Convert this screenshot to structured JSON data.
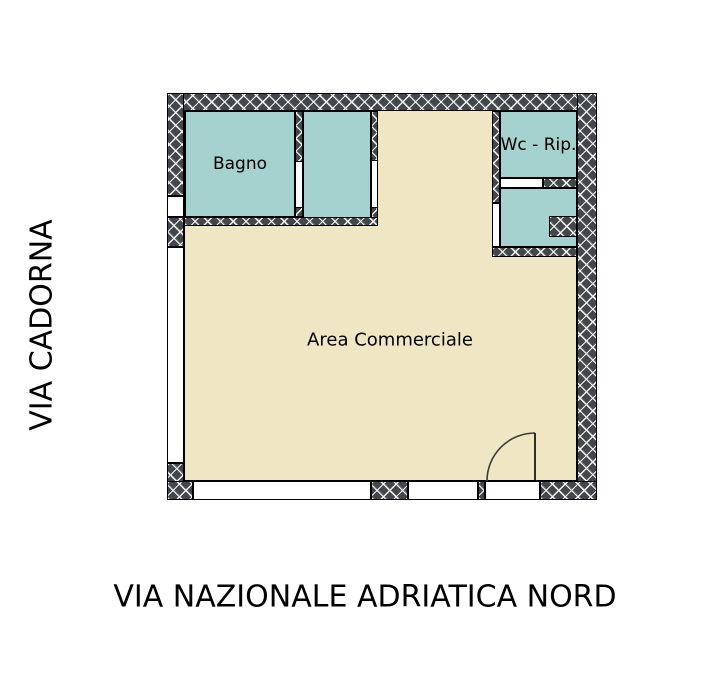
{
  "streets": {
    "left": "VIA CADORNA",
    "bottom": "VIA NAZIONALE ADRIATICA NORD"
  },
  "rooms": {
    "bagno": "Bagno",
    "wc_rip": "Wc - Rip.",
    "area": "Area Commerciale"
  },
  "colors": {
    "wall": "#43464b",
    "hatch": "#f5f5f5",
    "room": "#a5d2ce",
    "floor": "#efe7c3",
    "line": "#000000"
  }
}
